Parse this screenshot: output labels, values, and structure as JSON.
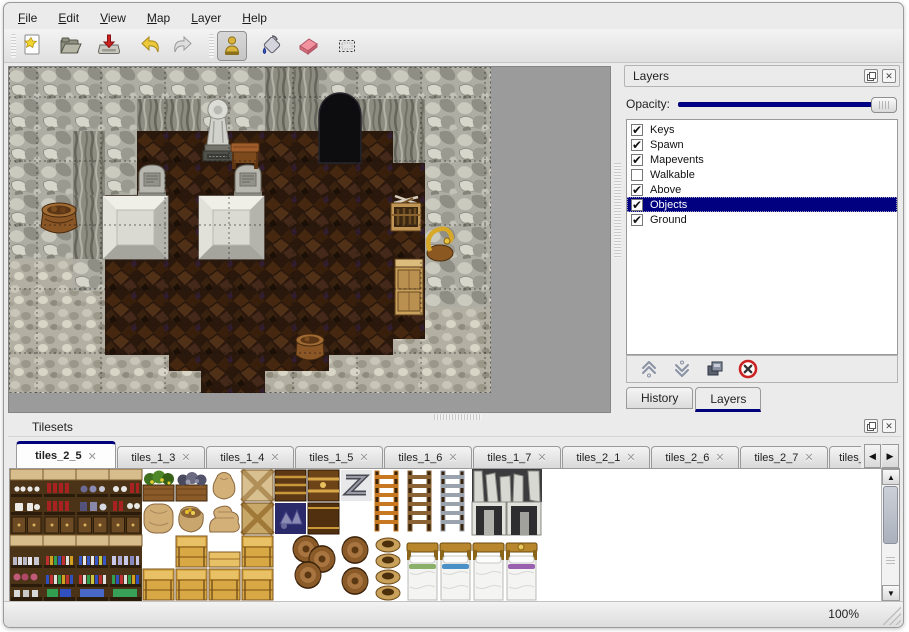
{
  "menu_bar": {
    "items": [
      "File",
      "Edit",
      "View",
      "Map",
      "Layer",
      "Help"
    ]
  },
  "toolbar": {
    "icons": [
      "new-file-icon",
      "open-folder-icon",
      "save-icon",
      "undo-icon",
      "redo-icon",
      "stamp-tool-icon",
      "fill-tool-icon",
      "eraser-tool-icon",
      "rect-select-tool-icon"
    ],
    "active_tool": "stamp-tool"
  },
  "layers_panel": {
    "title": "Layers",
    "opacity_label": "Opacity:",
    "opacity_value_pct": 100,
    "layers": [
      {
        "name": "Keys",
        "checked": true,
        "selected": false
      },
      {
        "name": "Spawn",
        "checked": true,
        "selected": false
      },
      {
        "name": "Mapevents",
        "checked": true,
        "selected": false
      },
      {
        "name": "Walkable",
        "checked": false,
        "selected": false
      },
      {
        "name": "Above",
        "checked": true,
        "selected": false
      },
      {
        "name": "Objects",
        "checked": true,
        "selected": true
      },
      {
        "name": "Ground",
        "checked": true,
        "selected": false
      }
    ],
    "toolbar_icons": [
      "move-layer-up-icon",
      "move-layer-down-icon",
      "duplicate-layer-icon",
      "delete-layer-icon"
    ],
    "tabs": [
      {
        "label": "History",
        "active": false
      },
      {
        "label": "Layers",
        "active": true
      }
    ]
  },
  "tilesets_panel": {
    "title": "Tilesets",
    "tabs": [
      {
        "label": "tiles_2_5",
        "active": true,
        "truncated": false
      },
      {
        "label": "tiles_1_3",
        "active": false,
        "truncated": false
      },
      {
        "label": "tiles_1_4",
        "active": false,
        "truncated": false
      },
      {
        "label": "tiles_1_5",
        "active": false,
        "truncated": false
      },
      {
        "label": "tiles_1_6",
        "active": false,
        "truncated": false
      },
      {
        "label": "tiles_1_7",
        "active": false,
        "truncated": false
      },
      {
        "label": "tiles_2_1",
        "active": false,
        "truncated": false
      },
      {
        "label": "tiles_2_6",
        "active": false,
        "truncated": false
      },
      {
        "label": "tiles_2_7",
        "active": false,
        "truncated": false
      },
      {
        "label": "tiles_",
        "active": false,
        "truncated": true
      }
    ]
  },
  "status_bar": {
    "zoom_level": "100%"
  },
  "colors": {
    "selection_navy": "#000080",
    "slider_navy": "#00008a",
    "active_tab_navy": "#00007d",
    "map_background_gray": "#9b9b9b",
    "eraser_pink": "#ee8490",
    "delete_red": "#cc2222",
    "undo_yellow": "#e8c830",
    "window_gray": "#ebebeb"
  }
}
